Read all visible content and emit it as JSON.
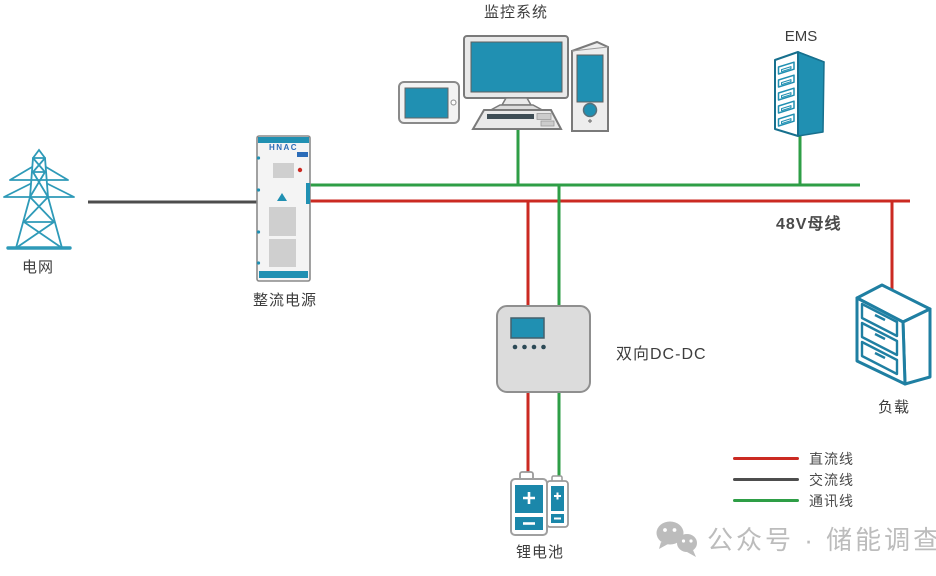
{
  "diagram": {
    "labels": {
      "monitoring": "监控系统",
      "ems": "EMS",
      "grid": "电网",
      "rectifier": "整流电源",
      "rectifier_logo": "HNAC",
      "dcdc": "双向DC-DC",
      "battery": "锂电池",
      "load": "负载",
      "bus": "48V母线"
    },
    "legend": {
      "items": [
        {
          "label": "直流线",
          "color": "#cb2a22"
        },
        {
          "label": "交流线",
          "color": "#4d4d4d"
        },
        {
          "label": "通讯线",
          "color": "#2e9e46"
        }
      ]
    },
    "watermark": "公众号 · 储能调查",
    "colors": {
      "dc_line": "#cb2a22",
      "ac_line": "#4d4d4d",
      "comm_line": "#2e9e46",
      "device_teal": "#2090b2",
      "outline_teal": "#1f7fa2",
      "label_text": "#3d3d3d",
      "watermark_gray": "#bcbcbc"
    }
  }
}
